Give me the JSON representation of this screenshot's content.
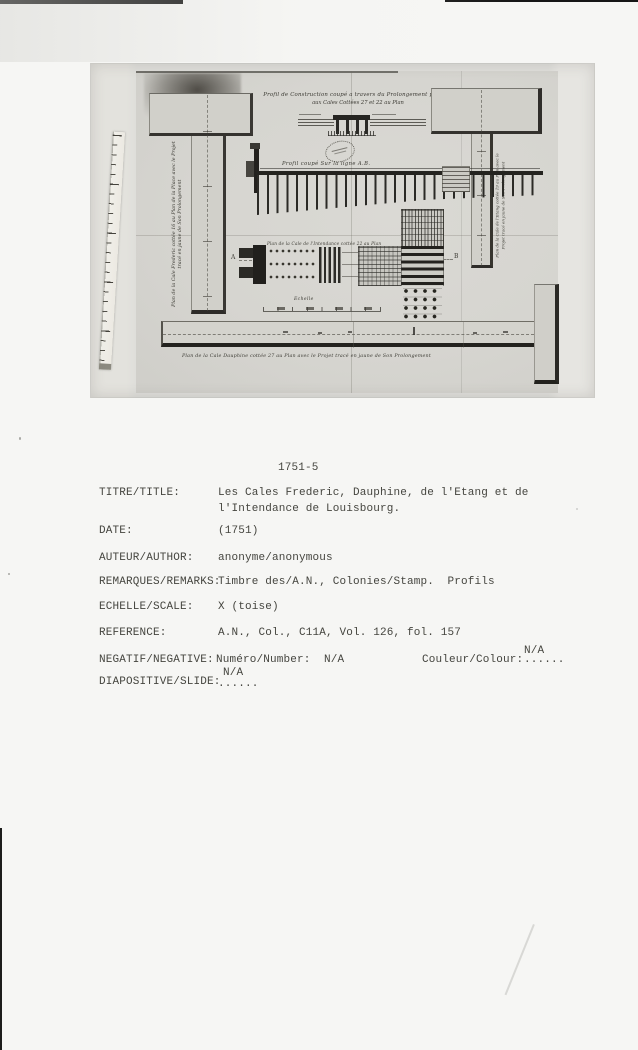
{
  "card": {
    "number": "1751-5",
    "rows": [
      {
        "label": "TITRE/TITLE:",
        "value": "Les Cales Frederic, Dauphine, de l'Etang et de",
        "value2": "l'Intendance de Louisbourg."
      },
      {
        "label": "DATE:",
        "value": "(1751)"
      },
      {
        "label": "AUTEUR/AUTHOR:",
        "value": "anonyme/anonymous"
      },
      {
        "label": "REMARQUES/REMARKS:",
        "value": "Timbre des/A.N., Colonies/Stamp.  Profils"
      },
      {
        "label": "ECHELLE/SCALE:",
        "value": "X (toise)"
      },
      {
        "label": "REFERENCE:",
        "value": "A.N., Col., C11A, Vol. 126, fol. 157"
      },
      {
        "label": "NEGATIF/NEGATIVE:",
        "value": "Numéro/Number:  N/A",
        "colour_label": "Couleur/Colour:",
        "colour_dots": "......",
        "colour_na": "N/A"
      },
      {
        "label": "DIAPOSITIVE/SLIDE:",
        "dots": "......",
        "na": "N/A"
      }
    ]
  },
  "drawing": {
    "title_line1": "Profil de Construction coupé a travers du Prolongement projetté",
    "title_line2": "aux Cales Cottées 27 et 22 au Plan",
    "profil_label": "Profil coupé Sur la ligne A.B.",
    "intendance_label": "Plan de la Cale de l'Intendance cottée 22 au Plan",
    "dauphine_label": "Plan de la Cale Dauphine cottée 27 au Plan avec le Projet tracé en jaune de Son Prolongement",
    "frederic_label_line1": "Plan de la Cale Frederic cottée 16 au Plan de la Place avec le Projet",
    "frederic_label_line2": "tracé en jaune de Son Prolongement",
    "etang_label_line1": "Plan de la Cale de l'Etang cottée 19 au Plan avec le",
    "etang_label_line2": "Projet tracé en jaune de Son Prolongement",
    "echelle_label": "Echelle",
    "point_a": "A",
    "point_b": "B"
  },
  "colors": {
    "page_background": "#f6f6f4",
    "photo_background": "#dededa",
    "sheet_background": "#d6d5d0",
    "drawing_ink": "#2a2925",
    "typed_text": "#45453f"
  }
}
